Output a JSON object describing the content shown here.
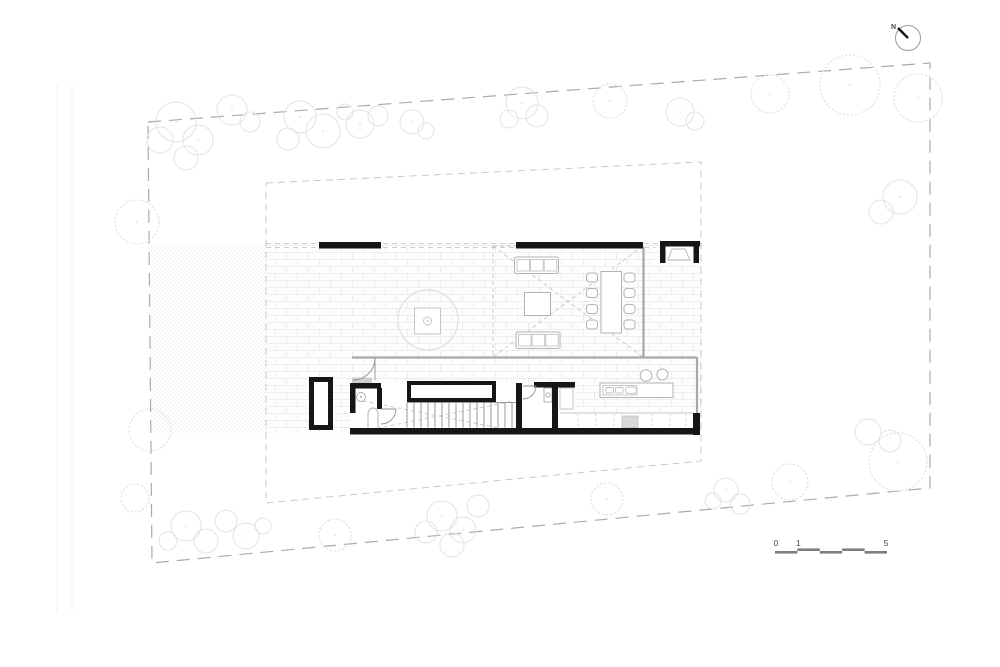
{
  "drawing": {
    "north_indicator": {
      "label": "N"
    },
    "scale_bar": {
      "labels": [
        "0",
        "1",
        "5"
      ]
    },
    "colors": {
      "background": "#ffffff",
      "wall_black": "#161616",
      "wall_gray": "#a8a8a8",
      "boundary_dash": "#ababab",
      "envelope_dash": "#c9c9c9",
      "tree_outline": "#e3e3e3",
      "scale_bar": "#7d7d7d",
      "label_text": "#444444"
    }
  }
}
